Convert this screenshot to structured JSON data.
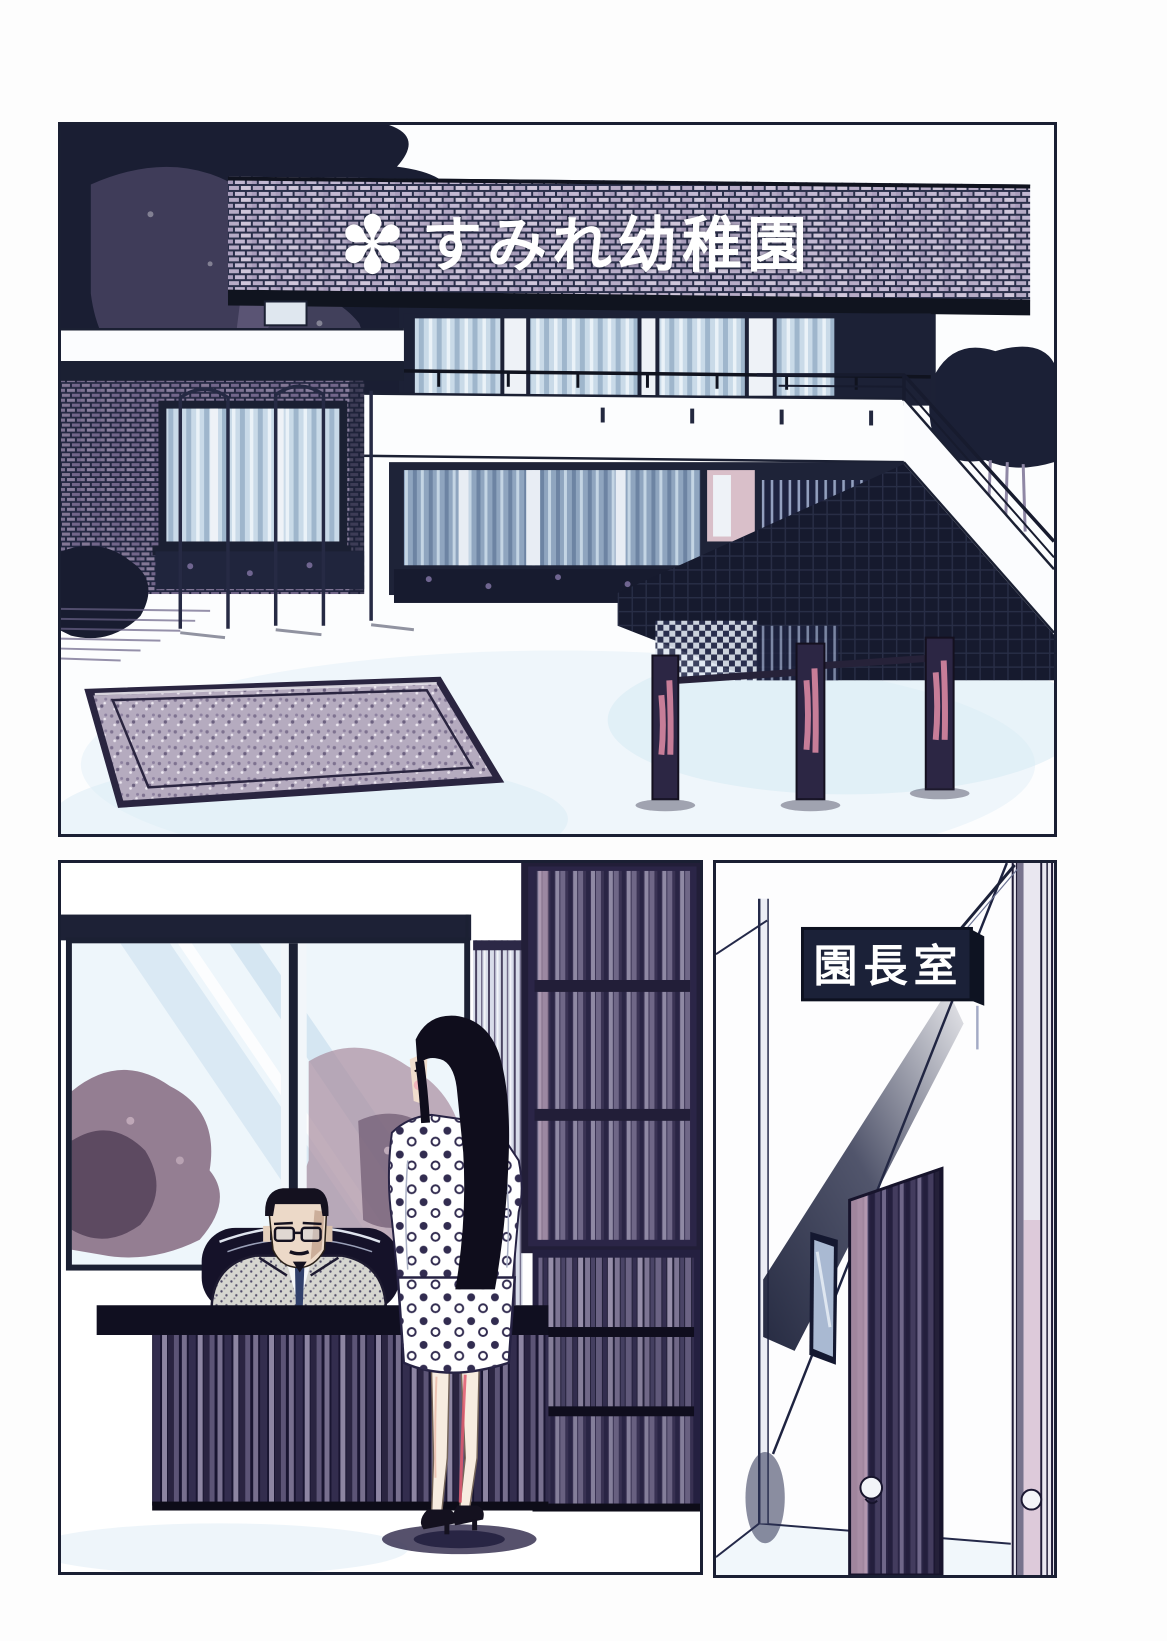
{
  "signs": {
    "kindergarten": {
      "mark": "✽",
      "text": "すみれ幼稚園",
      "text_color": "#ffffff",
      "background": "brick"
    },
    "principal_office": {
      "text": "園長室",
      "background": "#1b2138",
      "text_color": "#ffffff"
    }
  },
  "palette": {
    "ink": "#1a1f33",
    "brick_light": "#b6abc6",
    "glass_blue": "#c9dae8",
    "courtyard_wash": "#e3f0f7",
    "tree_mauve": "#8a7186",
    "post_pink": "#d887a2",
    "leg_shade_red": "#e0596f",
    "skin": "#ecd9c8",
    "door_mauve": "#c9a8bd"
  }
}
